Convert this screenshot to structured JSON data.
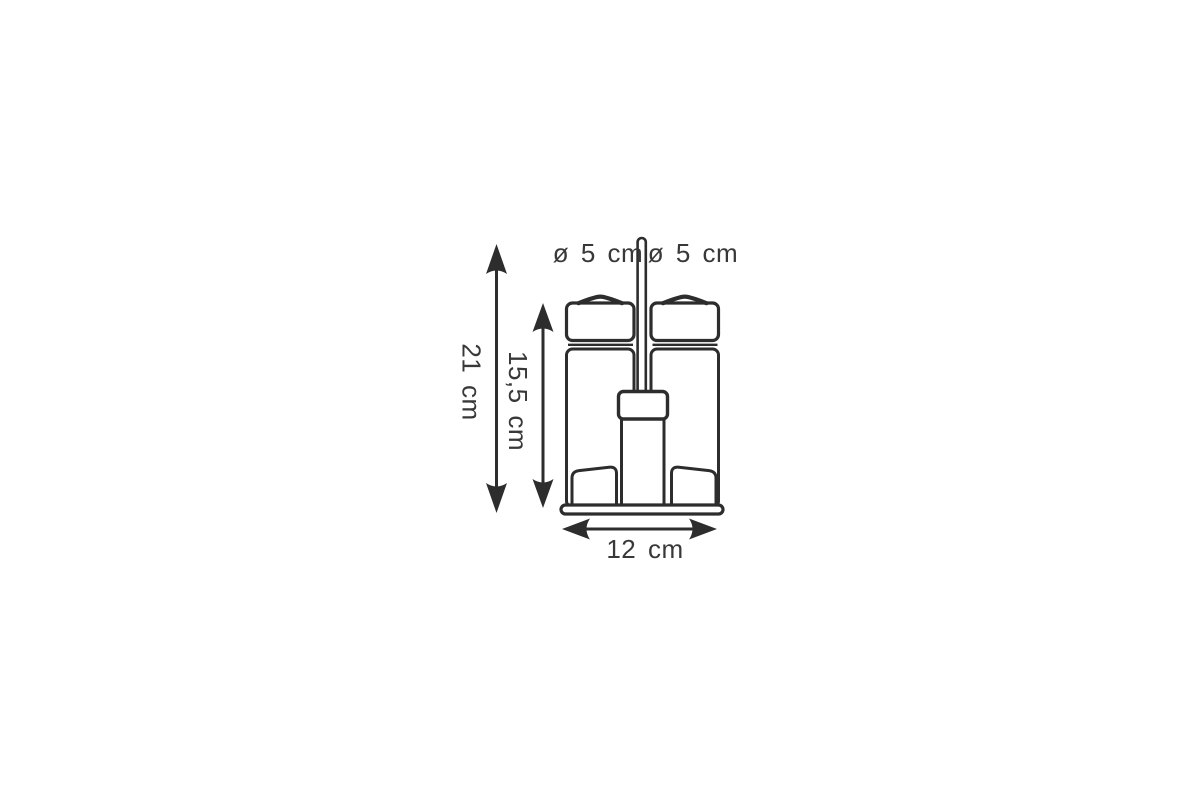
{
  "diagram": {
    "description": "Technical line drawing of a two-bottle cruet shaker set on a stand with carrying handle, annotated with dimensions",
    "dimensions": {
      "left_bottle_diameter": "ø 5 cm",
      "right_bottle_diameter": "ø 5 cm",
      "total_height": "21 cm",
      "bottle_height": "15,5 cm",
      "base_width": "12 cm"
    },
    "colors": {
      "line": "#2d2d2d",
      "text": "#383838",
      "background": "#ffffff"
    }
  }
}
